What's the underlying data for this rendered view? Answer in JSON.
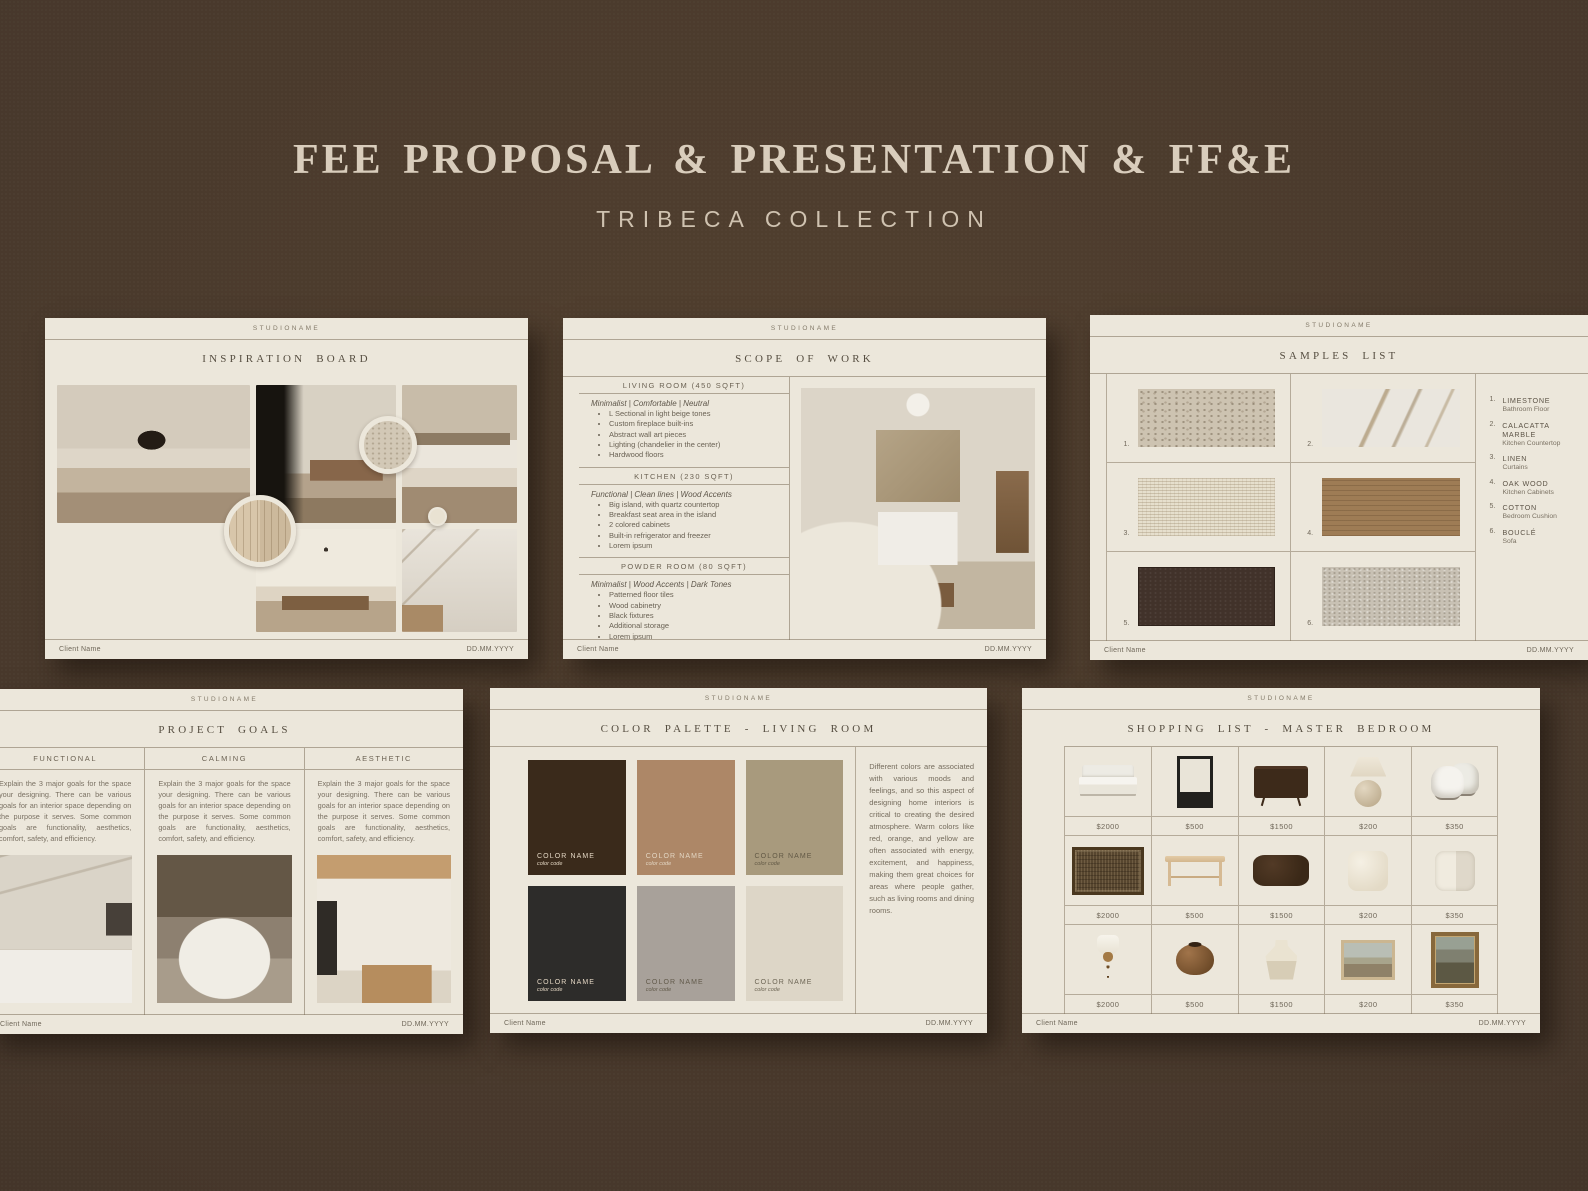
{
  "poster": {
    "title": "FEE PROPOSAL & PRESENTATION & FF&E",
    "subtitle": "TRIBECA COLLECTION"
  },
  "common": {
    "studio": "STUDIONAME",
    "client": "Client Name",
    "date": "DD.MM.YYYY"
  },
  "inspiration": {
    "title": "INSPIRATION BOARD",
    "photos": [
      "living-room",
      "entryway",
      "bedroom",
      "wood-table-detail",
      "dining-room",
      "marble-kitchen"
    ],
    "material_circles": [
      "limestone",
      "oak-wood",
      "cream-plaster"
    ]
  },
  "scope": {
    "title": "SCOPE OF WORK",
    "sections": [
      {
        "heading": "LIVING ROOM (450 SQFT)",
        "style_line": "Minimalist | Comfortable | Neutral",
        "bullets": [
          "L Sectional in light beige tones",
          "Custom fireplace built-ins",
          "Abstract wall art pieces",
          "Lighting (chandelier in the center)",
          "Hardwood floors"
        ]
      },
      {
        "heading": "KITCHEN (230 SQFT)",
        "style_line": "Functional | Clean lines | Wood Accents",
        "bullets": [
          "Big island, with quartz countertop",
          "Breakfast seat area in the island",
          "2 colored cabinets",
          "Built-in refrigerator and freezer",
          "Lorem ipsum"
        ]
      },
      {
        "heading": "POWDER ROOM (80 SQFT)",
        "style_line": "Minimalist | Wood Accents | Dark Tones",
        "bullets": [
          "Patterned floor tiles",
          "Wood cabinetry",
          "Black fixtures",
          "Additional storage",
          "Lorem ipsum"
        ]
      }
    ]
  },
  "samples": {
    "title": "SAMPLES LIST",
    "swatch_hex": [
      "#cdc3b1",
      "#eae6de",
      "#e6dfcd",
      "#9e7c55",
      "#41322a",
      "#c8c1b4"
    ],
    "legend": [
      {
        "num": "1.",
        "name": "LIMESTONE",
        "use": "Bathroom Floor"
      },
      {
        "num": "2.",
        "name": "CALACATTA MARBLE",
        "use": "Kitchen Countertop"
      },
      {
        "num": "3.",
        "name": "LINEN",
        "use": "Curtains"
      },
      {
        "num": "4.",
        "name": "OAK WOOD",
        "use": "Kitchen Cabinets"
      },
      {
        "num": "5.",
        "name": "COTTON",
        "use": "Bedroom Cushion"
      },
      {
        "num": "6.",
        "name": "BOUCLÉ",
        "use": "Sofa"
      }
    ]
  },
  "goals": {
    "title": "PROJECT GOALS",
    "columns": [
      {
        "heading": "FUNCTIONAL",
        "body": "Explain the 3 major goals for the space your designing. There can be various goals for an interior space depending on the purpose it serves. Some common goals are functionality, aesthetics, comfort, safety, and efficiency."
      },
      {
        "heading": "CALMING",
        "body": "Explain the 3 major goals for the space your designing. There can be various goals for an interior space depending on the purpose it serves. Some common goals are functionality, aesthetics, comfort, safety, and efficiency."
      },
      {
        "heading": "AESTHETIC",
        "body": "Explain the 3 major goals for the space your designing. There can be various goals for an interior space depending on the purpose it serves. Some common goals are functionality, aesthetics, comfort, safety, and efficiency."
      }
    ]
  },
  "palette": {
    "title": "COLOR PALETTE - LIVING ROOM",
    "swatches": [
      {
        "name": "COLOR NAME",
        "code": "color code",
        "hex": "#3a2a1b"
      },
      {
        "name": "COLOR NAME",
        "code": "color code",
        "hex": "#ad8767"
      },
      {
        "name": "COLOR NAME",
        "code": "color code",
        "hex": "#a89a7d"
      },
      {
        "name": "COLOR NAME",
        "code": "color code",
        "hex": "#2d2c2a"
      },
      {
        "name": "COLOR NAME",
        "code": "color code",
        "hex": "#a8a19a"
      },
      {
        "name": "COLOR NAME",
        "code": "color code",
        "hex": "#ddd6c7"
      }
    ],
    "paragraph": "Different colors are associated with various moods and feelings, and so this aspect of designing home interiors is critical to creating the desired atmosphere. Warm colors like red, orange, and yellow are often associated with energy, excitement, and happiness, making them great choices for areas where people gather, such as living rooms and dining rooms."
  },
  "shopping": {
    "title": "SHOPPING LIST - MASTER BEDROOM",
    "items": [
      {
        "product": "bed",
        "price": "$2000"
      },
      {
        "product": "nightstand",
        "price": "$500"
      },
      {
        "product": "dresser",
        "price": "$1500"
      },
      {
        "product": "table-lamp",
        "price": "$200"
      },
      {
        "product": "accent-chair",
        "price": "$350"
      },
      {
        "product": "rug",
        "price": "$2000"
      },
      {
        "product": "bench",
        "price": "$500"
      },
      {
        "product": "lumbar-pillow",
        "price": "$1500"
      },
      {
        "product": "throw-pillow",
        "price": "$200"
      },
      {
        "product": "patchwork-pillow",
        "price": "$350"
      },
      {
        "product": "wall-sconce",
        "price": "$2000"
      },
      {
        "product": "round-vase",
        "price": "$500"
      },
      {
        "product": "ceramic-vase",
        "price": "$1500"
      },
      {
        "product": "framed-landscape-art",
        "price": "$200"
      },
      {
        "product": "framed-vintage-art",
        "price": "$350"
      }
    ]
  }
}
